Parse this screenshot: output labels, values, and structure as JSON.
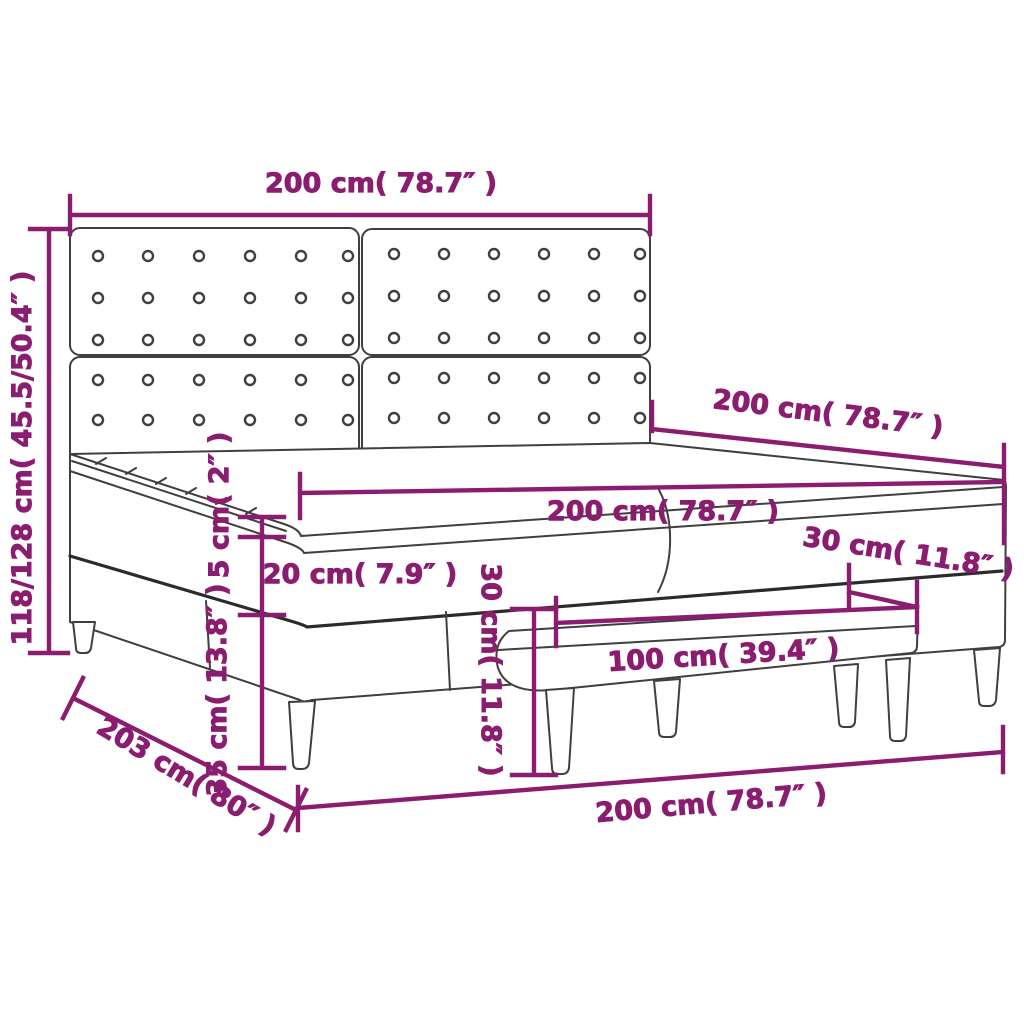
{
  "diagram": {
    "type": "product dimension diagram",
    "product": "box spring bed with tufted headboard, mattress topper and bench",
    "colors": {
      "dimension_accent": "#8B1D70",
      "line_art": "#3F3F3F",
      "background": "#FFFFFF"
    },
    "dimensions": {
      "headboard_width": "200 cm( 78.7″ )",
      "total_height": "118/128 cm( 45.5/50.4″ )",
      "bed_length_top": "200 cm( 78.7″ )",
      "mattress_width": "200 cm( 78.7″ )",
      "box_spring_height_right": "30 cm( 11.8″ )",
      "topper_thickness": "5 cm( 2″ )",
      "mattress_thickness": "20 cm( 7.9″ )",
      "base_leg_height": "35 cm( 13.8″ )",
      "bench_height": "30 cm( 11.8″ )",
      "bench_width": "100 cm( 39.4″ )",
      "bed_length_diagonal": "203 cm( 80″ )",
      "bed_width_bottom": "200 cm( 78.7″ )"
    }
  }
}
